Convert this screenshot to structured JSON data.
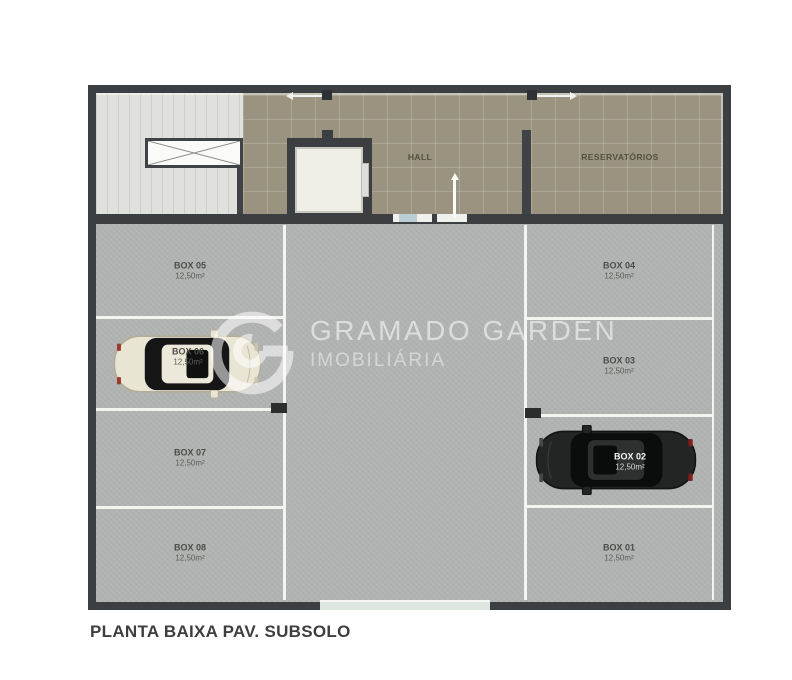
{
  "plan": {
    "title": "PLANTA BAIXA PAV. SUBSOLO",
    "rooms": {
      "hall": "HALL",
      "reservoirs": "RESERVATÓRIOS"
    },
    "stalls": {
      "left": [
        {
          "label": "BOX 05",
          "area": "12,50m²"
        },
        {
          "label": "BOX 06",
          "area": "12,50m²"
        },
        {
          "label": "BOX 07",
          "area": "12,50m²"
        },
        {
          "label": "BOX 08",
          "area": "12,50m²"
        }
      ],
      "right": [
        {
          "label": "BOX 04",
          "area": "12,50m²"
        },
        {
          "label": "BOX 03",
          "area": "12,50m²"
        },
        {
          "label": "BOX 02",
          "area": "12,50m²"
        },
        {
          "label": "BOX 01",
          "area": "12,50m²"
        }
      ]
    },
    "cars": [
      {
        "box": "BOX 06",
        "color_name": "white",
        "facing": "right"
      },
      {
        "box": "BOX 02",
        "color_name": "black",
        "facing": "left"
      }
    ]
  },
  "watermark": {
    "brand": "GRAMADO GARDEN",
    "subtitle": "IMOBILIÁRIA"
  },
  "colors": {
    "wall": "#3b3f42",
    "hall_floor": "#99937f",
    "stair_floor": "#e0e1dd",
    "parking_floor": "#b2b4b3",
    "stall_line": "#f3f3f0",
    "door_window": "#b9ced3",
    "garage_opening": "#dce6de",
    "white_car_body": "#e9e5d5",
    "black_car_body": "#222524"
  }
}
